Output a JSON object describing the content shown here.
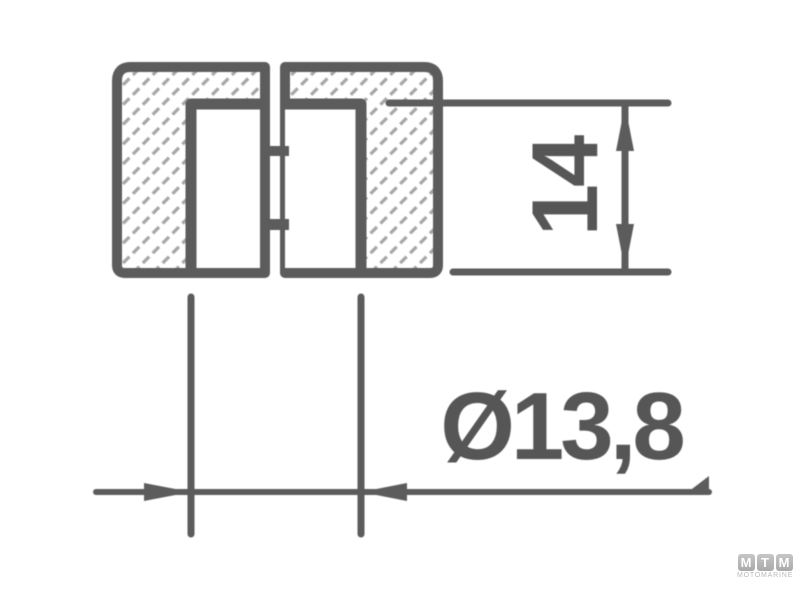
{
  "drawing": {
    "background_color": "#ffffff",
    "line_color": "#5c5c5c",
    "hatch_color": "#a6a6a6",
    "dimensions": {
      "height": {
        "label": "14",
        "orientation": "vertical"
      },
      "diameter": {
        "label": "Ø13,8",
        "orientation": "horizontal"
      }
    }
  },
  "watermark": {
    "letters": [
      "M",
      "T",
      "M"
    ],
    "subtitle": "MOTOMARINE",
    "tile_color": "#b2b2b2",
    "letter_color": "#ffffff",
    "subtitle_color": "#b9b9b9"
  }
}
